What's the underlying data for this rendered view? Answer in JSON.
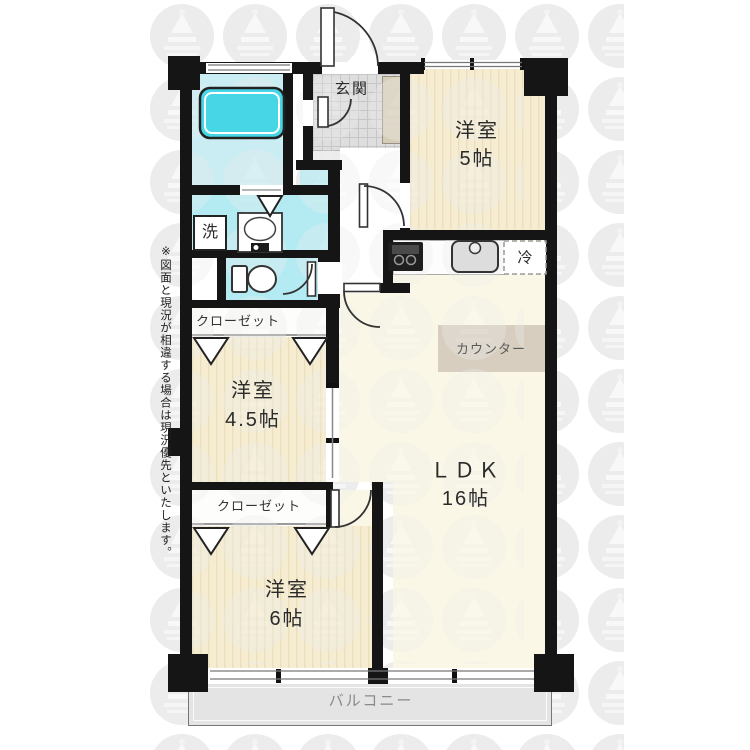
{
  "floorplan": {
    "note": "※図面と現況が相違する場合は現況優先といたします。",
    "entrance": {
      "label": "玄関"
    },
    "room5": {
      "name": "洋室",
      "size": "5帖"
    },
    "room45": {
      "name": "洋室",
      "size": "4.5帖"
    },
    "room6": {
      "name": "洋室",
      "size": "6帖"
    },
    "ldk": {
      "name": "ＬＤＫ",
      "size": "16帖"
    },
    "closet_upper": {
      "label": "クローゼット"
    },
    "closet_lower": {
      "label": "クローゼット"
    },
    "washer": {
      "label": "洗"
    },
    "fridge": {
      "label": "冷"
    },
    "counter": {
      "label": "カウンター"
    },
    "balcony": {
      "label": "バルコニー"
    },
    "colors": {
      "wall": "#151515",
      "tub": "#46d6e6",
      "bath_floor": "#c9edf2",
      "wet_floor": "#b4ebf2",
      "tatami_stripe": "#f6ecd2",
      "ldk_floor": "#fbf7e6",
      "counter_fill": "#d8cec0",
      "balcony_fill": "#e4e4e4",
      "entrance_tile": "#dedede"
    }
  }
}
